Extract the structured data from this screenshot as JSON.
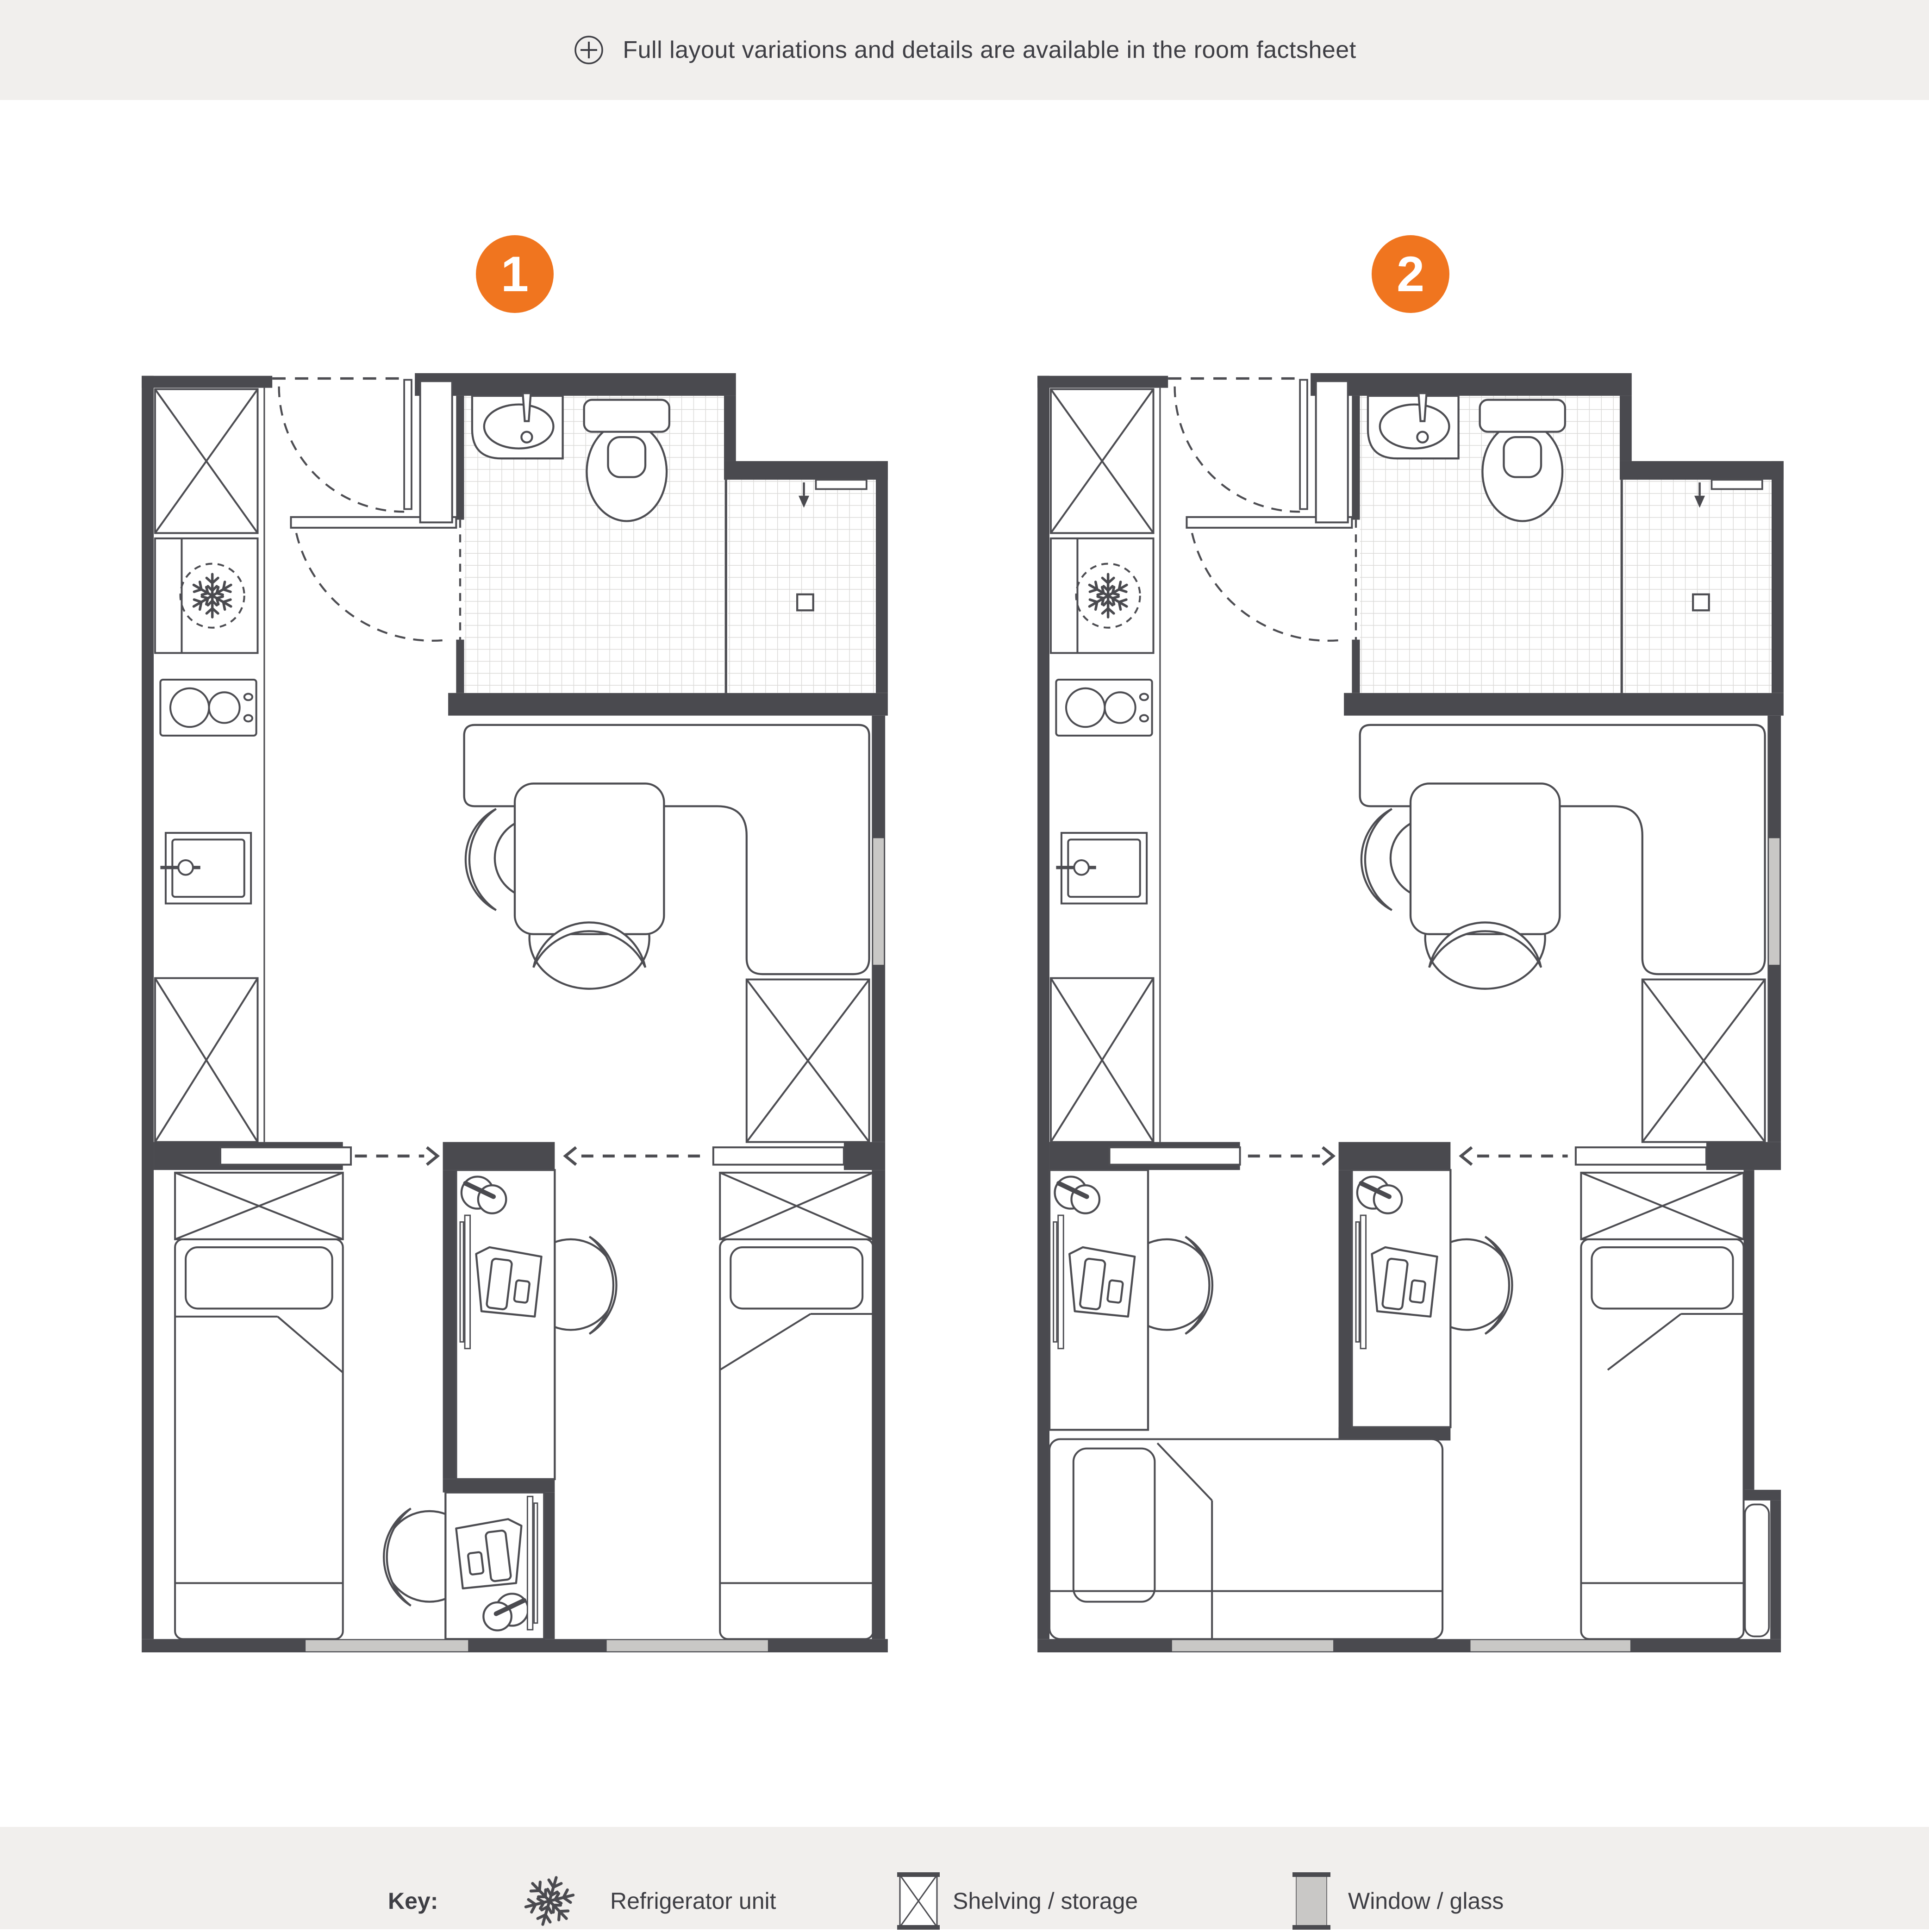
{
  "header": {
    "icon": "plus-circle-icon",
    "note": "Full layout variations and details are available in the room factsheet"
  },
  "plans": [
    {
      "badge": "1",
      "name": "layout-variation-1"
    },
    {
      "badge": "2",
      "name": "layout-variation-2"
    }
  ],
  "legend": {
    "title": "Key:",
    "items": [
      {
        "icon": "snowflake-icon",
        "label": "Refrigerator unit"
      },
      {
        "icon": "crossed-box-icon",
        "label": "Shelving / storage"
      },
      {
        "icon": "glass-swatch-icon",
        "label": "Window / glass"
      }
    ]
  },
  "colors": {
    "wall": "#4a4a4f",
    "accent_orange": "#f0751f",
    "glass": "#c9c8c6",
    "band": "#f1efed",
    "tile_line": "#dbdad8"
  }
}
